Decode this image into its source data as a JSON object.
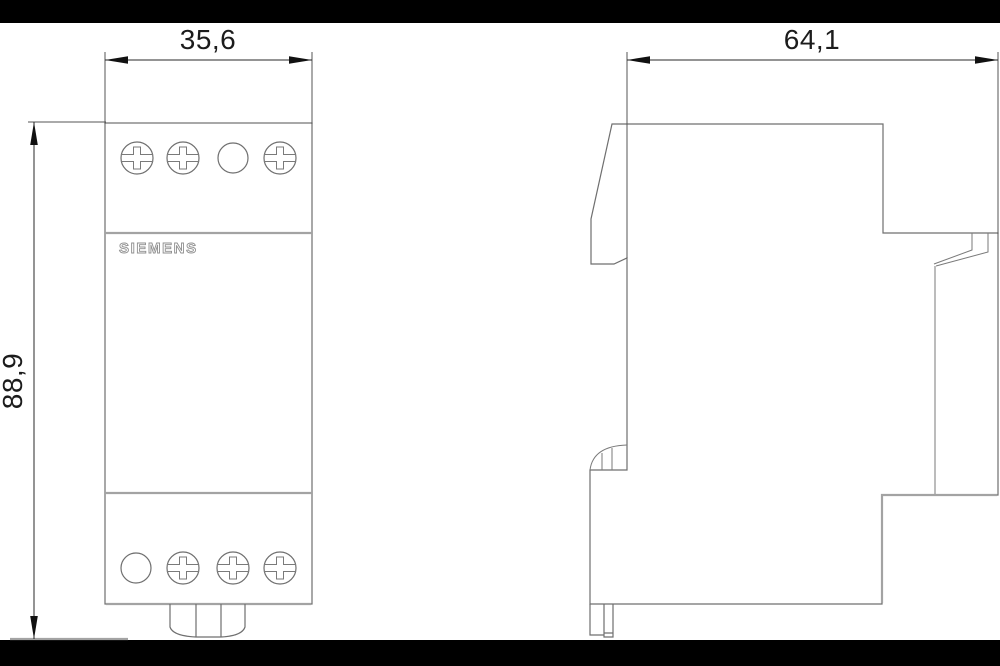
{
  "drawing": {
    "brand_label": "SIEMENS",
    "dimensions": {
      "width_label": "35,6",
      "height_label": "88,9",
      "depth_label": "64,1"
    },
    "icons": {
      "screw": "phillips-combination-screw",
      "hole": "round-terminal-hole"
    },
    "colors": {
      "background": "#ffffff",
      "letterbox": "#000000",
      "outline": "#6f6f6f",
      "accent_line": "#a3a3a3",
      "dimension": "#1c1c1c",
      "brand_text_outline": "#8f8f8f"
    }
  }
}
